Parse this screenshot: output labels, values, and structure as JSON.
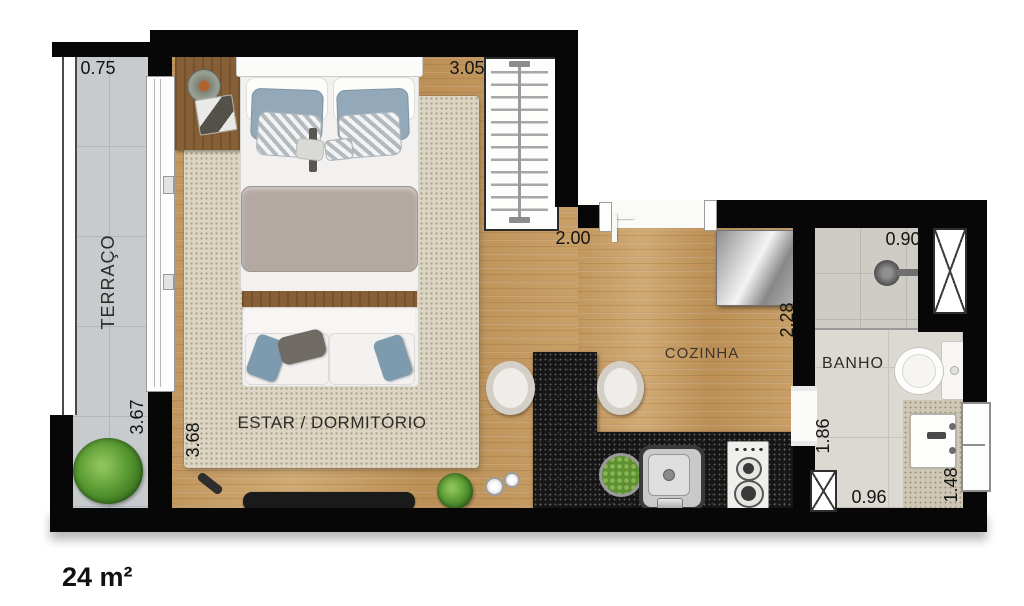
{
  "meta": {
    "area_label": "24 m²"
  },
  "rooms": {
    "terraco": {
      "label": "TERRAÇO"
    },
    "estar": {
      "label": "ESTAR / DORMITÓRIO"
    },
    "cozinha": {
      "label": "COZINHA"
    },
    "banho": {
      "label": "BANHO"
    }
  },
  "dimensions": {
    "terraco_width": "0.75",
    "terraco_length": "3.67",
    "estar_length": "3.68",
    "estar_width": "3.05",
    "cozinha_width": "2.00",
    "cozinha_depth": "2.28",
    "banho_width": "0.90",
    "banho_length": "1.86",
    "banho_bottom_width": "0.96",
    "banho_right_depth": "1.48"
  },
  "colors": {
    "wall": "#070707",
    "wood_floor": "#c79e67",
    "rug": "#ddd5c3",
    "terrace_tile": "#c7cbce",
    "bath_tile": "#dcd9d3",
    "counter_granite": "#161616",
    "counter_beige": "#cfc6b4",
    "pillow_blue": "#93a8b8",
    "blanket_taupe": "#b3a8a2",
    "plant_green": "#4e8f2e"
  }
}
